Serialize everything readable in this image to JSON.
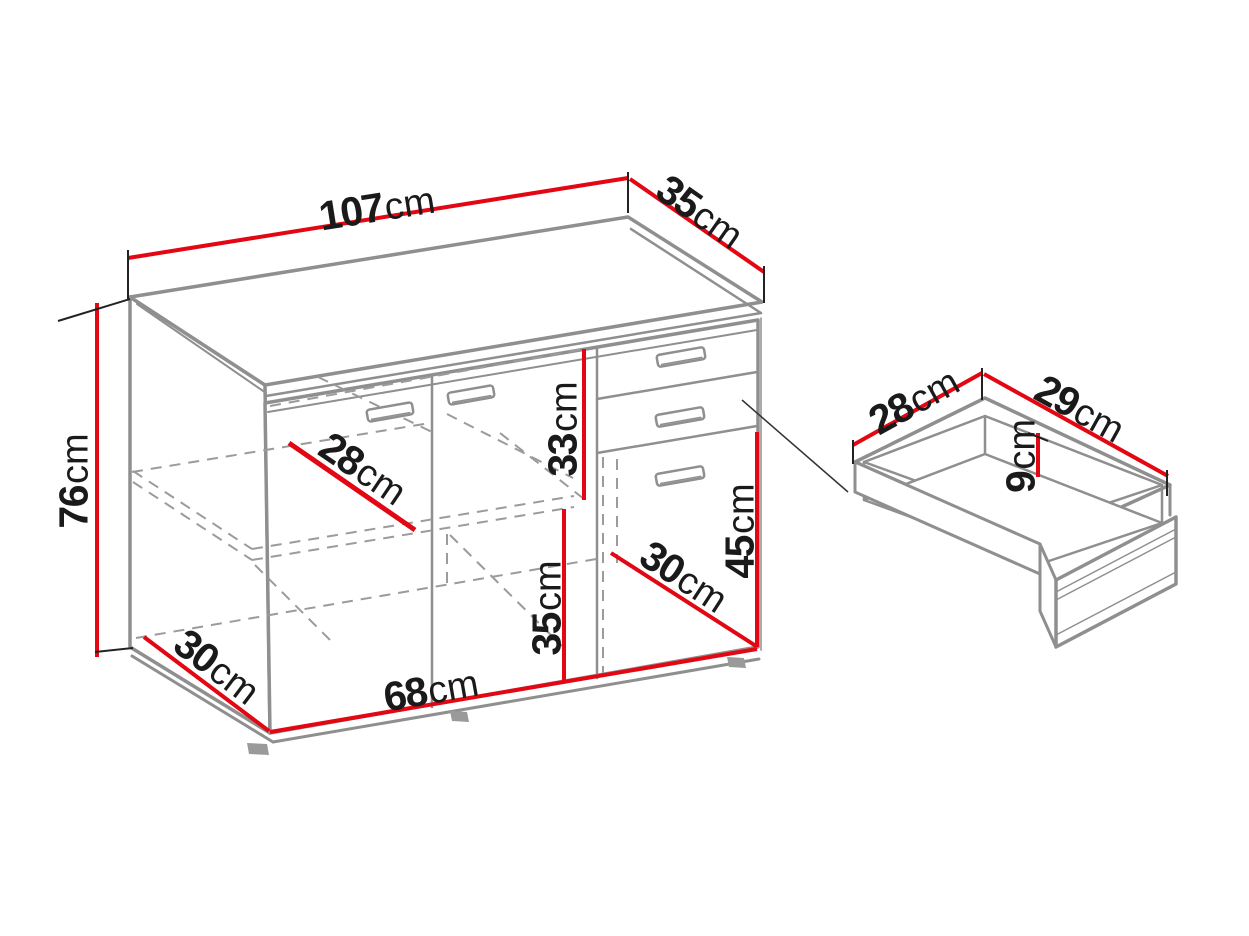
{
  "diagram_type": "furniture-dimension-drawing",
  "colors": {
    "dimension_line": "#e30613",
    "structure_line": "#8f8f8f",
    "hidden_line": "#9b9b9b",
    "label_text": "#1a1a1a",
    "background": "#ffffff"
  },
  "cabinet": {
    "dimensions": [
      {
        "name": "total-width",
        "value": "107",
        "unit": "cm"
      },
      {
        "name": "total-depth",
        "value": "35",
        "unit": "cm"
      },
      {
        "name": "total-height",
        "value": "76",
        "unit": "cm"
      },
      {
        "name": "interior-depth",
        "value": "28",
        "unit": "cm"
      },
      {
        "name": "upper-compartment-height",
        "value": "33",
        "unit": "cm"
      },
      {
        "name": "lower-compartment-height",
        "value": "35",
        "unit": "cm"
      },
      {
        "name": "drawer-door-front-height",
        "value": "45",
        "unit": "cm"
      },
      {
        "name": "drawer-compartment-depth",
        "value": "30",
        "unit": "cm"
      },
      {
        "name": "interior-width",
        "value": "68",
        "unit": "cm"
      },
      {
        "name": "base-depth",
        "value": "30",
        "unit": "cm"
      }
    ]
  },
  "drawer_detail": {
    "dimensions": [
      {
        "name": "drawer-width",
        "value": "28",
        "unit": "cm"
      },
      {
        "name": "drawer-depth",
        "value": "29",
        "unit": "cm"
      },
      {
        "name": "drawer-inner-height",
        "value": "9",
        "unit": "cm"
      }
    ]
  }
}
